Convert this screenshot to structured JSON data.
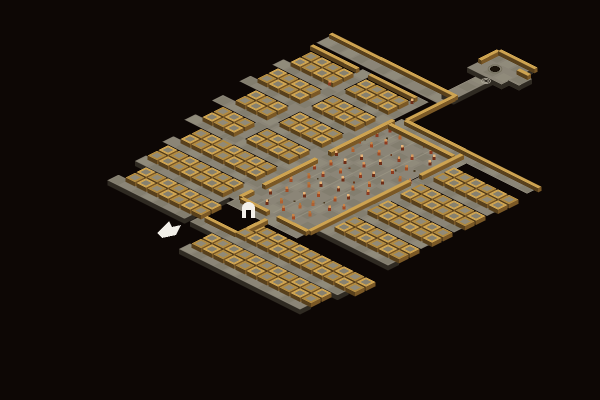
{
  "scene": {
    "iso": {
      "ox": 333,
      "oy": 40,
      "hw": 11,
      "hh": 5.5
    },
    "palette": {
      "bg": "#0d0705",
      "floor_a": "#8b8577",
      "floor_b": "#7d7869",
      "floor_c": "#969080",
      "floor_edge": "#2f2a22",
      "wall_top": "#cda351",
      "wall_top_dark": "#b08a42",
      "wall_side_light": "#7a5826",
      "wall_side_dark": "#58401c",
      "cell_floor": "#87816f",
      "cell_floor_b": "#918a77",
      "dwarf_body": [
        "#8e3a1f",
        "#a34a22",
        "#6e2d16",
        "#b06030"
      ],
      "dwarf_head": [
        "#d99a5e",
        "#c8854a",
        "#e8b57a",
        "#b5763d"
      ],
      "speck": [
        "#4a3a22",
        "#6b3a1e"
      ],
      "white": "#f2efe9",
      "well_dark": "#191209",
      "well_ring": "#76715f",
      "ripple": "#a8a294",
      "seam": "#a29c8b"
    },
    "corridors": [
      {
        "u": -0.5,
        "v": -0.15,
        "nu": 11.0,
        "nv": 1.15,
        "edge": false
      },
      {
        "u": -0.5,
        "v": 4,
        "nu": 10.0,
        "nv": 1,
        "edge": false
      },
      {
        "u": -0.5,
        "v": 7,
        "nu": 10.0,
        "nv": 1,
        "edge": false
      },
      {
        "u": 0,
        "v": 10,
        "nu": 9.6,
        "nv": 1,
        "edge": false
      },
      {
        "u": 0.5,
        "v": 13,
        "nu": 9.1,
        "nv": 1,
        "edge": false
      },
      {
        "u": 1.5,
        "v": 16,
        "nu": 8.1,
        "nv": 1,
        "edge": false
      },
      {
        "u": 2,
        "v": 19,
        "nu": 7.6,
        "nv": 1,
        "edge": true
      },
      {
        "u": 2.5,
        "v": 22,
        "nu": 7.0,
        "nv": 1,
        "edge": true
      },
      {
        "u": 4,
        "v": 1.3,
        "nu": 1,
        "nv": 14.7,
        "edge": false
      },
      {
        "u": 9,
        "v": 1.3,
        "nu": 1,
        "nv": 17.7,
        "edge": false
      },
      {
        "u": 10.3,
        "v": 4.05,
        "nu": 12.5,
        "nv": 1.1,
        "edge": false
      },
      {
        "u": 16.35,
        "v": 5.1,
        "nu": 0.95,
        "nv": 12.9,
        "edge": false
      },
      {
        "u": 16.5,
        "v": 8,
        "nu": 6.5,
        "nv": 1,
        "edge": false
      },
      {
        "u": 16.5,
        "v": 11,
        "nu": 6.5,
        "nv": 1,
        "edge": false
      },
      {
        "u": 16.5,
        "v": 14,
        "nu": 6.5,
        "nv": 1,
        "edge": false
      },
      {
        "u": 16.5,
        "v": 17,
        "nu": 6.5,
        "nv": 1,
        "edge": true
      },
      {
        "u": 10,
        "v": 18.6,
        "nu": 6.4,
        "nv": 1.1,
        "edge": false
      },
      {
        "u": 10,
        "v": 22,
        "nu": 13.4,
        "nv": 1,
        "edge": true
      },
      {
        "u": 12,
        "v": 25,
        "nu": 11,
        "nv": 1,
        "edge": true
      },
      {
        "u": 9.8,
        "v": -3.65,
        "nu": 1.1,
        "nv": 3.6,
        "edge": true
      },
      {
        "u": 8.6,
        "v": -6.5,
        "nu": 3.1,
        "nv": 2.9,
        "edge": true
      },
      {
        "u": 11.6,
        "v": -5.5,
        "nu": 1.0,
        "nv": 1.2,
        "edge": true
      }
    ],
    "hall": {
      "u": 10,
      "v": 5,
      "nu": 6.3,
      "nv": 13.6,
      "seams_u": [
        11.5,
        13,
        14.5
      ]
    },
    "cell_rows": [
      {
        "v": 2,
        "u0": 0,
        "n": 9,
        "skip": [
          4
        ]
      },
      {
        "v": 3,
        "u0": 0,
        "n": 9,
        "skip": [
          4
        ]
      },
      {
        "v": 5,
        "u0": 0,
        "n": 9,
        "skip": [
          4
        ]
      },
      {
        "v": 6,
        "u0": 0,
        "n": 9,
        "skip": [
          4
        ]
      },
      {
        "v": 8,
        "u0": 1,
        "n": 8,
        "skip": [
          4
        ]
      },
      {
        "v": 9,
        "u0": 1,
        "n": 8,
        "skip": [
          4
        ]
      },
      {
        "v": 11,
        "u0": 1,
        "n": 8,
        "skip": [
          4
        ]
      },
      {
        "v": 12,
        "u0": 1,
        "n": 8,
        "skip": [
          4
        ]
      },
      {
        "v": 14,
        "u0": 2,
        "n": 7,
        "skip": []
      },
      {
        "v": 15,
        "u0": 2,
        "n": 7,
        "skip": []
      },
      {
        "v": 17,
        "u0": 2,
        "n": 7,
        "skip": []
      },
      {
        "v": 18,
        "u0": 2,
        "n": 7,
        "skip": []
      },
      {
        "v": 20,
        "u0": 3,
        "n": 7,
        "skip": []
      },
      {
        "v": 21,
        "u0": 3,
        "n": 7,
        "skip": []
      },
      {
        "v": 6,
        "u0": 17,
        "n": 6,
        "skip": []
      },
      {
        "v": 7,
        "u0": 17,
        "n": 6,
        "skip": []
      },
      {
        "v": 9,
        "u0": 17,
        "n": 6,
        "skip": []
      },
      {
        "v": 10,
        "u0": 17,
        "n": 6,
        "skip": []
      },
      {
        "v": 12,
        "u0": 17,
        "n": 6,
        "skip": []
      },
      {
        "v": 13,
        "u0": 17,
        "n": 6,
        "skip": []
      },
      {
        "v": 15,
        "u0": 17,
        "n": 6,
        "skip": []
      },
      {
        "v": 16,
        "u0": 17,
        "n": 6,
        "skip": []
      },
      {
        "v": 20,
        "u0": 13,
        "n": 11,
        "skip": []
      },
      {
        "v": 21,
        "u0": 13,
        "n": 11,
        "skip": []
      },
      {
        "v": 23,
        "u0": 12,
        "n": 11,
        "skip": []
      },
      {
        "v": 24,
        "u0": 12,
        "n": 11,
        "skip": []
      }
    ],
    "wall_runs": [
      {
        "d": "u",
        "u": -0.7,
        "v": -0.65,
        "len": 11.4
      },
      {
        "d": "u",
        "u": -0.5,
        "v": 1.3,
        "len": 4.2
      },
      {
        "d": "u",
        "u": 4.8,
        "v": 1.3,
        "len": 4.2
      },
      {
        "d": "v",
        "u": 10.45,
        "v": -0.4,
        "len": 4.3
      },
      {
        "d": "u",
        "u": 10.6,
        "v": 3.85,
        "len": 12.2
      },
      {
        "d": "v",
        "u": 9.85,
        "v": 4.5,
        "len": 5.8
      },
      {
        "d": "v",
        "u": 9.85,
        "v": 11.5,
        "len": 4.8
      },
      {
        "d": "v",
        "u": 9.85,
        "v": 17.3,
        "len": 1.1
      },
      {
        "d": "v",
        "u": 16.1,
        "v": 4.5,
        "len": 3.8
      },
      {
        "d": "v",
        "u": 16.1,
        "v": 9.3,
        "len": 9.1
      },
      {
        "d": "u",
        "u": 10.2,
        "v": 4.9,
        "len": 5.8
      },
      {
        "d": "u",
        "u": 10.2,
        "v": 18.35,
        "len": 2.4
      },
      {
        "d": "u",
        "u": 13.5,
        "v": 18.35,
        "len": 2.7
      },
      {
        "d": "u",
        "u": 10.3,
        "v": 21.7,
        "len": 2.8
      },
      {
        "d": "v",
        "u": 13.1,
        "v": 19.3,
        "len": 2.5
      },
      {
        "d": "u",
        "u": 8.5,
        "v": -6.8,
        "len": 3.3
      },
      {
        "d": "v",
        "u": 8.3,
        "v": -6.6,
        "len": 1.7
      },
      {
        "d": "u",
        "u": 11.1,
        "v": -5.9,
        "len": 1.0
      }
    ],
    "dwarves": [
      [
        11.0,
        5.8
      ],
      [
        12.1,
        6.0
      ],
      [
        13.9,
        5.6
      ],
      [
        14.8,
        5.9
      ],
      [
        15.5,
        6.3
      ],
      [
        10.8,
        6.8
      ],
      [
        11.9,
        7.1
      ],
      [
        13.2,
        6.9
      ],
      [
        14.5,
        7.3
      ],
      [
        15.8,
        7.0
      ],
      [
        10.6,
        8.2
      ],
      [
        11.5,
        8.0
      ],
      [
        12.6,
        8.4
      ],
      [
        14.1,
        8.1
      ],
      [
        15.2,
        8.5
      ],
      [
        11.1,
        9.3
      ],
      [
        12.2,
        9.6
      ],
      [
        13.5,
        9.2
      ],
      [
        14.9,
        9.5
      ],
      [
        15.9,
        9.8
      ],
      [
        10.7,
        10.4
      ],
      [
        11.8,
        10.7
      ],
      [
        13.0,
        10.2
      ],
      [
        14.3,
        10.6
      ],
      [
        15.4,
        10.9
      ],
      [
        11.3,
        11.5
      ],
      [
        12.5,
        11.8
      ],
      [
        13.8,
        11.3
      ],
      [
        15.0,
        11.7
      ],
      [
        10.9,
        12.6
      ],
      [
        12.0,
        12.9
      ],
      [
        13.3,
        12.4
      ],
      [
        14.6,
        12.8
      ],
      [
        15.7,
        12.5
      ],
      [
        11.5,
        13.7
      ],
      [
        12.8,
        13.9
      ],
      [
        14.0,
        13.5
      ],
      [
        15.2,
        13.8
      ],
      [
        11.0,
        14.8
      ],
      [
        12.3,
        14.5
      ],
      [
        13.6,
        14.9
      ],
      [
        14.8,
        14.6
      ],
      [
        15.9,
        14.9
      ],
      [
        11.7,
        15.9
      ],
      [
        13.0,
        15.6
      ],
      [
        14.2,
        16.0
      ],
      [
        15.4,
        15.7
      ],
      [
        11.2,
        16.9
      ],
      [
        12.5,
        17.2
      ],
      [
        13.8,
        16.8
      ],
      [
        15.0,
        17.1
      ],
      [
        12.0,
        18.0
      ],
      [
        13.3,
        17.8
      ],
      [
        14.5,
        18.1
      ],
      [
        16.6,
        9.6
      ],
      [
        16.7,
        10.3
      ],
      [
        4.0,
        4.3
      ],
      [
        9.4,
        2.2
      ]
    ],
    "specks": [
      [
        11.4,
        6.5
      ],
      [
        13.1,
        7.8
      ],
      [
        14.7,
        9.0
      ],
      [
        12.4,
        10.9
      ],
      [
        15.3,
        12.2
      ],
      [
        11.9,
        13.3
      ],
      [
        14.4,
        15.2
      ],
      [
        12.9,
        16.4
      ],
      [
        10.5,
        7.6
      ],
      [
        15.6,
        8.2
      ],
      [
        13.9,
        12.0
      ],
      [
        11.6,
        17.5
      ]
    ],
    "props": {
      "cursor_arrow_points": [
        [
          157,
          233
        ],
        [
          169,
          221
        ],
        [
          172,
          227
        ],
        [
          181,
          225
        ],
        [
          176,
          235
        ],
        [
          162,
          238
        ]
      ],
      "archway": {
        "x": 242,
        "y": 202,
        "w": 13,
        "h": 16,
        "notch_w": 5,
        "notch_h": 8
      },
      "well": {
        "x": 495,
        "y": 69,
        "rx": 5.2,
        "ry": 3.0
      },
      "ripples": {
        "x": 486,
        "y": 81,
        "r1x": 4.5,
        "r1y": 2.6,
        "r2x": 2.4,
        "r2y": 1.4
      }
    }
  }
}
